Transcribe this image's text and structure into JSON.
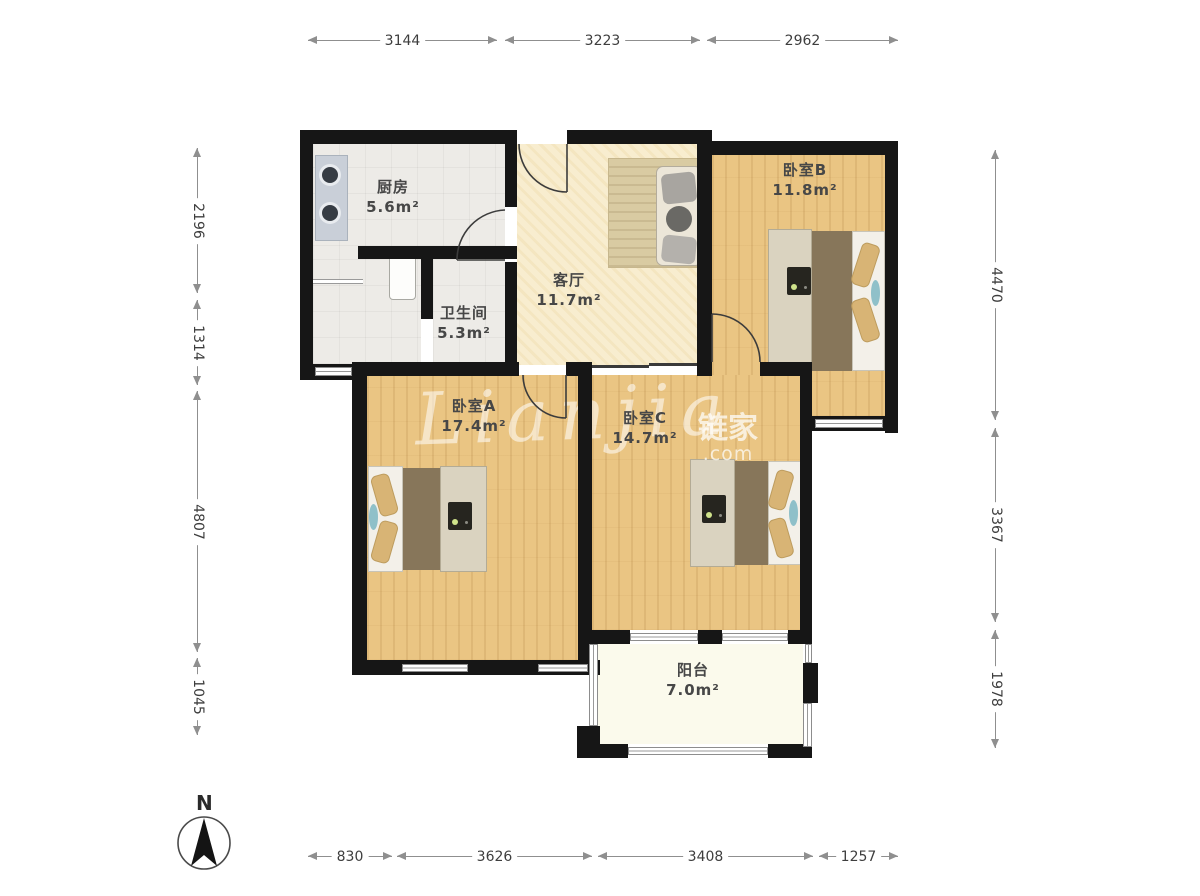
{
  "rooms": {
    "kitchen": {
      "name": "厨房",
      "area": "5.6m²"
    },
    "bathroom": {
      "name": "卫生间",
      "area": "5.3m²"
    },
    "living": {
      "name": "客厅",
      "area": "11.7m²"
    },
    "bedroomB": {
      "name": "卧室B",
      "area": "11.8m²"
    },
    "bedroomA": {
      "name": "卧室A",
      "area": "17.4m²"
    },
    "bedroomC": {
      "name": "卧室C",
      "area": "14.7m²"
    },
    "balcony": {
      "name": "阳台",
      "area": "7.0m²"
    }
  },
  "dims": {
    "top": [
      {
        "label": "3144"
      },
      {
        "label": "3223"
      },
      {
        "label": "2962"
      }
    ],
    "bottom": [
      {
        "label": "830"
      },
      {
        "label": "3626"
      },
      {
        "label": "3408"
      },
      {
        "label": "1257"
      }
    ],
    "left": [
      {
        "label": "2196"
      },
      {
        "label": "1314"
      },
      {
        "label": "4807"
      },
      {
        "label": "1045"
      }
    ],
    "right": [
      {
        "label": "4470"
      },
      {
        "label": "3367"
      },
      {
        "label": "1978"
      }
    ]
  },
  "compass": {
    "north_label": "N"
  },
  "watermark": {
    "script": "Lianjia",
    "brand": "链家",
    "suffix": ".com"
  },
  "colors": {
    "wall": "#161616",
    "wood_floor": "#eac583",
    "living_floor": "#f8edcf",
    "tile_floor": "#edebe7",
    "balcony_floor": "#fbfaec",
    "accent_teal": "#8fc0c9",
    "pillow_tan": "#d8b475",
    "dimension_line": "#8f8f8f"
  }
}
